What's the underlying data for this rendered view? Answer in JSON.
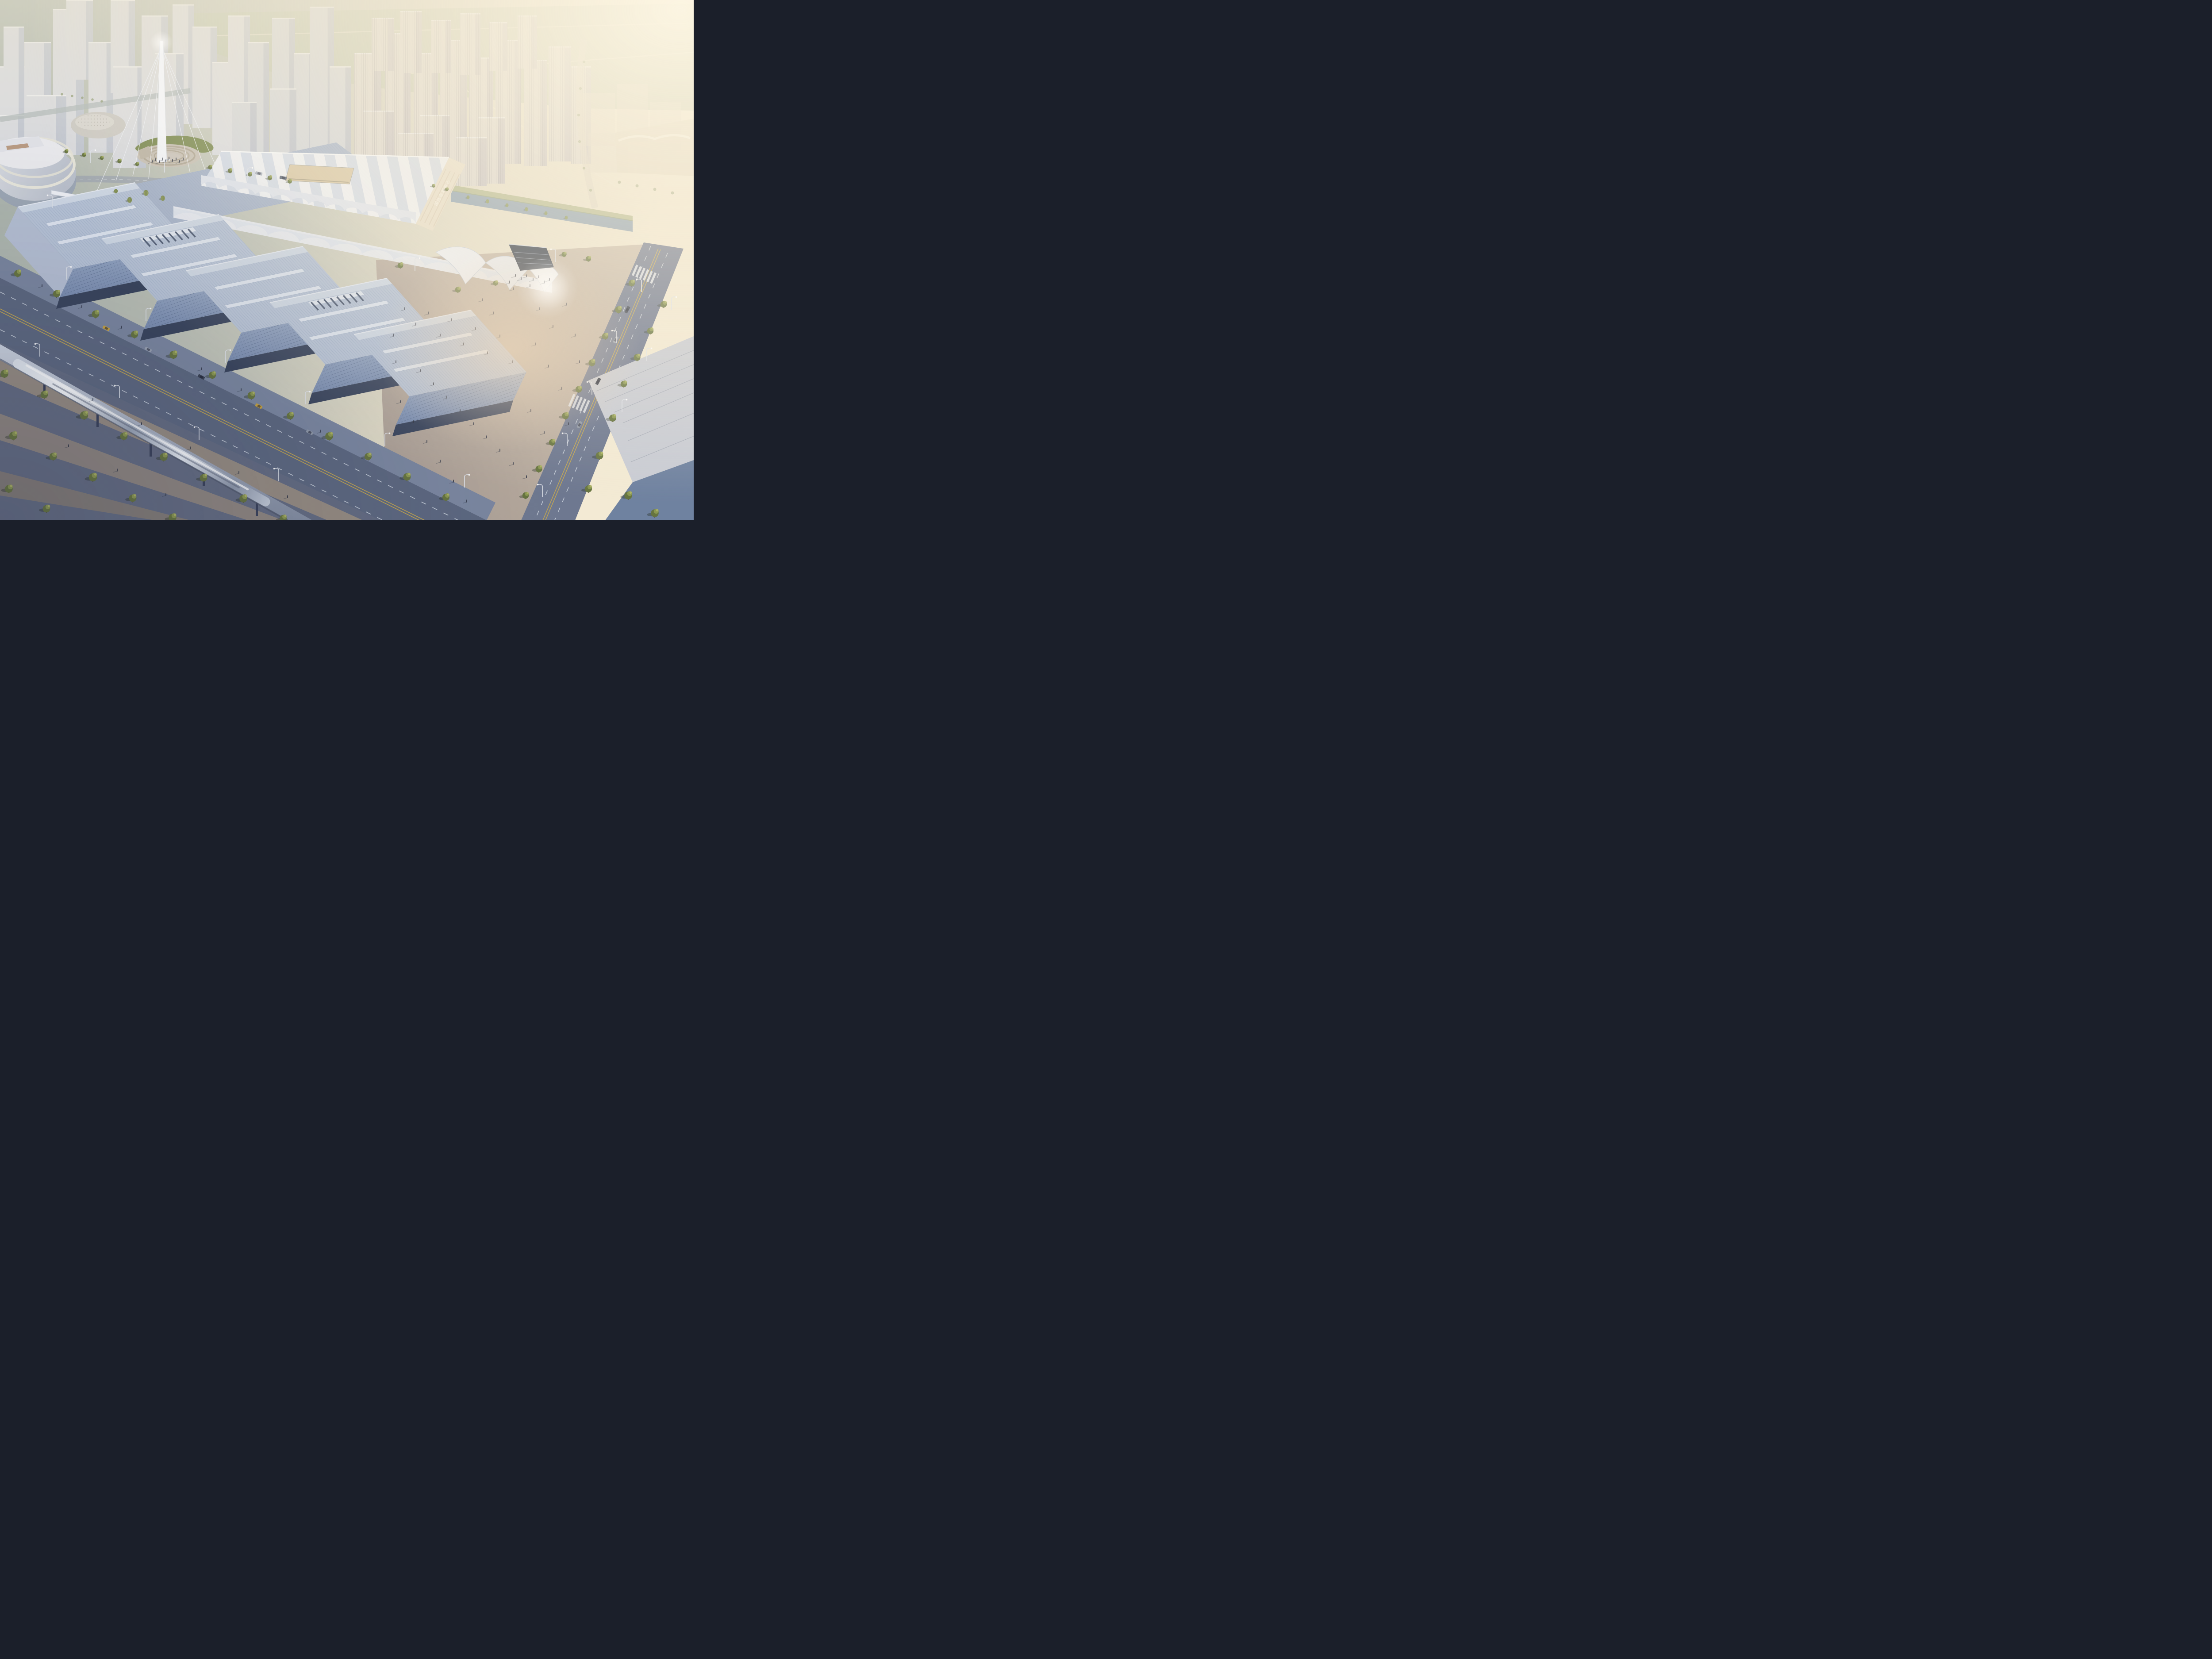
{
  "sign": {
    "text": "国际会展中心"
  },
  "palette": {
    "sky_left": "#a9b3ac",
    "sky_warm": "#f1e7cf",
    "glow": "#fdf6e3",
    "field": "#b7c0a8",
    "tower_face": "#d7dae2",
    "tower_side": "#bcc3d2",
    "cream_tower": "#d9d5d0",
    "cream_side": "#c2bec3",
    "tent_white": "#eef0f4",
    "tent_shade": "#dfe4ee",
    "tent_facade": "#e7ddc9",
    "roof_rib": "#b9c5d8",
    "roof_back": "#a7b4ca",
    "facade_top": "#9aabc6",
    "facade_bottom": "#7b8eb1",
    "arcade": "#39445c",
    "road_dark": "#5d6880",
    "road_mid": "#6e7890",
    "sidewalk": "#7b87a0",
    "park_ground": "#646c82",
    "path_tan": "#9f9283",
    "plaza_warm": "#b5a9a1",
    "plaza_glare": "#f0d9ba",
    "water": "#7e96ad",
    "tree_green": "#66743f",
    "tree_light": "#aab163",
    "willow": "#7d8b4f",
    "mast_white": "#f4f6f9",
    "train_silver": "#c9d1dd",
    "lane_yellow": "#c8a94e",
    "lane_white": "#dfe5ee",
    "wedge_dark": "#2f3848"
  },
  "scene": {
    "bg_left": [
      [
        0,
        150,
        70,
        260
      ],
      [
        55,
        95,
        60,
        300
      ],
      [
        8,
        60,
        46,
        210
      ],
      [
        120,
        20,
        70,
        330
      ],
      [
        150,
        0,
        60,
        180
      ],
      [
        200,
        95,
        55,
        250
      ],
      [
        250,
        0,
        55,
        210
      ],
      [
        255,
        150,
        75,
        230
      ],
      [
        320,
        35,
        60,
        300
      ],
      [
        390,
        10,
        48,
        270
      ],
      [
        350,
        120,
        65,
        250
      ],
      [
        435,
        60,
        55,
        230
      ],
      [
        60,
        215,
        90,
        190
      ],
      [
        0,
        260,
        55,
        170
      ],
      [
        480,
        140,
        60,
        210
      ],
      [
        515,
        35,
        50,
        230
      ]
    ],
    "bg_mid": [
      [
        560,
        95,
        48,
        260
      ],
      [
        615,
        40,
        52,
        300
      ],
      [
        665,
        120,
        45,
        230
      ],
      [
        700,
        15,
        55,
        320
      ],
      [
        745,
        150,
        48,
        210
      ],
      [
        610,
        200,
        60,
        170
      ],
      [
        525,
        230,
        55,
        160
      ]
    ],
    "bg_res": [
      [
        800,
        120,
        62,
        260
      ],
      [
        870,
        75,
        58,
        300
      ],
      [
        935,
        120,
        55,
        260
      ],
      [
        995,
        90,
        60,
        290
      ],
      [
        1060,
        130,
        55,
        250
      ],
      [
        1120,
        90,
        58,
        280
      ],
      [
        1185,
        135,
        52,
        240
      ],
      [
        1240,
        105,
        50,
        260
      ],
      [
        1290,
        150,
        46,
        220
      ],
      [
        820,
        250,
        70,
        170
      ],
      [
        950,
        260,
        66,
        160
      ],
      [
        1080,
        265,
        62,
        150
      ],
      [
        900,
        300,
        80,
        120
      ],
      [
        1030,
        310,
        70,
        110
      ],
      [
        840,
        40,
        50,
        120
      ],
      [
        905,
        25,
        48,
        140
      ],
      [
        975,
        45,
        44,
        120
      ],
      [
        1040,
        30,
        46,
        140
      ],
      [
        1105,
        50,
        42,
        110
      ],
      [
        1170,
        35,
        44,
        120
      ]
    ],
    "bg_far": [
      [
        1310,
        210,
        80,
        120
      ],
      [
        1395,
        190,
        70,
        130
      ],
      [
        1470,
        230,
        70,
        110
      ],
      [
        1330,
        300,
        90,
        90
      ]
    ],
    "halls": [
      {
        "p": [
          40,
          468
        ],
        "vent": false
      },
      {
        "p": [
          230,
          540
        ],
        "vent": true
      },
      {
        "p": [
          420,
          612
        ],
        "vent": false
      },
      {
        "p": [
          610,
          684
        ],
        "vent": true
      },
      {
        "p": [
          800,
          756
        ],
        "vent": false
      }
    ],
    "trees": [
      [
        40,
        618,
        1,
        0
      ],
      [
        128,
        664,
        1,
        0
      ],
      [
        216,
        710,
        1.05,
        0
      ],
      [
        304,
        756,
        1,
        0
      ],
      [
        392,
        802,
        1.1,
        0
      ],
      [
        480,
        848,
        1,
        0
      ],
      [
        568,
        894,
        1.05,
        0
      ],
      [
        656,
        940,
        1,
        0
      ],
      [
        744,
        986,
        1.1,
        0
      ],
      [
        832,
        1032,
        1,
        0
      ],
      [
        920,
        1078,
        1.05,
        0
      ],
      [
        1008,
        1124,
        1,
        0
      ],
      [
        10,
        845,
        1.1,
        0
      ],
      [
        100,
        892,
        1.05,
        0
      ],
      [
        190,
        939,
        1.15,
        0
      ],
      [
        280,
        986,
        1.05,
        0
      ],
      [
        370,
        1033,
        1.1,
        0
      ],
      [
        460,
        1080,
        1.05,
        0
      ],
      [
        550,
        1127,
        1.1,
        0
      ],
      [
        640,
        1172,
        1,
        0
      ],
      [
        30,
        985,
        1.15,
        0
      ],
      [
        120,
        1032,
        1.05,
        0
      ],
      [
        210,
        1079,
        1.15,
        0
      ],
      [
        300,
        1126,
        1.05,
        0
      ],
      [
        390,
        1170,
        1.1,
        0
      ],
      [
        20,
        1105,
        1.1,
        0
      ],
      [
        105,
        1150,
        1.05,
        0
      ],
      [
        150,
        342,
        0.55,
        0
      ],
      [
        190,
        350,
        0.6,
        0
      ],
      [
        230,
        357,
        0.55,
        0
      ],
      [
        270,
        364,
        0.6,
        0
      ],
      [
        310,
        371,
        0.55,
        0
      ],
      [
        475,
        378,
        0.6,
        0
      ],
      [
        520,
        386,
        0.65,
        0
      ],
      [
        565,
        394,
        0.6,
        0
      ],
      [
        610,
        402,
        0.65,
        0
      ],
      [
        655,
        410,
        0.6,
        0
      ],
      [
        330,
        436,
        0.8,
        1
      ],
      [
        293,
        452,
        0.75,
        1
      ],
      [
        368,
        448,
        0.7,
        1
      ],
      [
        262,
        432,
        0.6,
        1
      ],
      [
        140,
        213,
        0.4,
        2
      ],
      [
        163,
        217,
        0.4,
        2
      ],
      [
        186,
        221,
        0.4,
        2
      ],
      [
        209,
        225,
        0.4,
        2
      ],
      [
        230,
        229,
        0.4,
        2
      ],
      [
        1058,
        446,
        0.5,
        1
      ],
      [
        1102,
        455,
        0.55,
        1
      ],
      [
        1146,
        464,
        0.5,
        1
      ],
      [
        1190,
        473,
        0.55,
        1
      ],
      [
        1234,
        482,
        0.5,
        1
      ],
      [
        1280,
        492,
        0.5,
        1
      ],
      [
        905,
        600,
        0.8,
        0
      ],
      [
        1275,
        575,
        0.7,
        0
      ],
      [
        1330,
        585,
        0.75,
        0
      ],
      [
        1428,
        640,
        0.9,
        0
      ],
      [
        1398,
        700,
        0.95,
        0
      ],
      [
        1368,
        760,
        0.9,
        0
      ],
      [
        1338,
        820,
        0.95,
        0
      ],
      [
        1308,
        880,
        0.9,
        0
      ],
      [
        1278,
        940,
        0.95,
        0
      ],
      [
        1248,
        1000,
        0.9,
        0
      ],
      [
        1218,
        1060,
        0.95,
        0
      ],
      [
        1188,
        1120,
        0.9,
        0
      ],
      [
        1500,
        688,
        0.9,
        0
      ],
      [
        1470,
        748,
        0.9,
        0
      ],
      [
        1440,
        808,
        0.95,
        0
      ],
      [
        1410,
        868,
        0.9,
        0
      ],
      [
        1385,
        945,
        1.0,
        0
      ],
      [
        1355,
        1030,
        1.05,
        0
      ],
      [
        1420,
        1120,
        1.1,
        0
      ],
      [
        1330,
        1105,
        1,
        0
      ],
      [
        1480,
        1160,
        1.1,
        0
      ],
      [
        1035,
        655,
        0.8,
        0
      ],
      [
        1120,
        640,
        0.7,
        0
      ],
      [
        980,
        420,
        0.5,
        0
      ],
      [
        1010,
        428,
        0.5,
        0
      ],
      [
        1320,
        140,
        0.45,
        2
      ],
      [
        1312,
        200,
        0.45,
        2
      ],
      [
        1308,
        260,
        0.45,
        2
      ],
      [
        1310,
        320,
        0.45,
        2
      ],
      [
        1320,
        380,
        0.45,
        2
      ],
      [
        1335,
        430,
        0.45,
        2
      ],
      [
        1400,
        412,
        0.5,
        2
      ],
      [
        1440,
        420,
        0.5,
        2
      ],
      [
        1480,
        428,
        0.5,
        2
      ],
      [
        1520,
        436,
        0.5,
        2
      ]
    ],
    "people": [
      [
        368,
        362
      ],
      [
        375,
        366
      ],
      [
        382,
        360
      ],
      [
        390,
        365
      ],
      [
        398,
        362
      ],
      [
        360,
        368
      ],
      [
        406,
        367
      ],
      [
        352,
        363
      ],
      [
        414,
        362
      ],
      [
        344,
        367
      ],
      [
        1165,
        625
      ],
      [
        1178,
        632
      ],
      [
        1190,
        626
      ],
      [
        1205,
        634
      ],
      [
        1218,
        628
      ],
      [
        1152,
        640
      ],
      [
        1230,
        640
      ],
      [
        1242,
        634
      ],
      [
        1198,
        648
      ],
      [
        1160,
        655
      ],
      [
        915,
        700
      ],
      [
        940,
        735
      ],
      [
        968,
        710
      ],
      [
        995,
        760
      ],
      [
        1020,
        725
      ],
      [
        1048,
        780
      ],
      [
        1075,
        745
      ],
      [
        1102,
        800
      ],
      [
        1130,
        762
      ],
      [
        1158,
        820
      ],
      [
        950,
        840
      ],
      [
        980,
        870
      ],
      [
        1010,
        900
      ],
      [
        1040,
        930
      ],
      [
        1070,
        960
      ],
      [
        1100,
        990
      ],
      [
        1130,
        1020
      ],
      [
        1160,
        1050
      ],
      [
        1190,
        1080
      ],
      [
        905,
        910
      ],
      [
        935,
        955
      ],
      [
        965,
        1000
      ],
      [
        995,
        1045
      ],
      [
        1025,
        1090
      ],
      [
        1055,
        1135
      ],
      [
        1220,
        700
      ],
      [
        1250,
        740
      ],
      [
        1280,
        690
      ],
      [
        1210,
        780
      ],
      [
        1240,
        830
      ],
      [
        1270,
        880
      ],
      [
        1200,
        930
      ],
      [
        1230,
        980
      ],
      [
        1090,
        680
      ],
      [
        1115,
        710
      ],
      [
        890,
        760
      ],
      [
        895,
        820
      ],
      [
        1300,
        760
      ],
      [
        1310,
        820
      ],
      [
        1285,
        960
      ],
      [
        95,
        648
      ],
      [
        185,
        695
      ],
      [
        275,
        742
      ],
      [
        455,
        836
      ],
      [
        545,
        883
      ],
      [
        725,
        977
      ],
      [
        210,
        905
      ],
      [
        320,
        960
      ],
      [
        430,
        1015
      ],
      [
        540,
        1070
      ],
      [
        650,
        1125
      ],
      [
        155,
        1010
      ],
      [
        265,
        1065
      ],
      [
        375,
        1120
      ]
    ],
    "cars": [
      [
        240,
        742,
        27,
        "#c7a23f"
      ],
      [
        335,
        790,
        27,
        "#99a2b2"
      ],
      [
        455,
        852,
        27,
        "#3a4254"
      ],
      [
        585,
        918,
        27,
        "#c7a23f"
      ],
      [
        700,
        977,
        27,
        "#8e97a6"
      ],
      [
        1418,
        700,
        118,
        "#39414f"
      ],
      [
        1392,
        768,
        118,
        "#9aa3b2"
      ],
      [
        1352,
        862,
        118,
        "#2f3746"
      ],
      [
        1310,
        960,
        118,
        "#8e97a6"
      ],
      [
        585,
        392,
        12,
        "#aab2bf"
      ],
      [
        640,
        402,
        12,
        "#5a6375"
      ]
    ],
    "lamps": [
      [
        150,
        632,
        0
      ],
      [
        330,
        726,
        0
      ],
      [
        510,
        820,
        0
      ],
      [
        690,
        914,
        0
      ],
      [
        870,
        1008,
        0
      ],
      [
        1050,
        1102,
        0
      ],
      [
        90,
        806,
        1
      ],
      [
        270,
        900,
        1
      ],
      [
        450,
        994,
        1
      ],
      [
        630,
        1088,
        1
      ],
      [
        1450,
        660,
        1
      ],
      [
        1394,
        776,
        1
      ],
      [
        1338,
        892,
        1
      ],
      [
        1282,
        1008,
        1
      ],
      [
        1226,
        1124,
        1
      ],
      [
        1518,
        700,
        0
      ],
      [
        1462,
        816,
        0
      ],
      [
        1406,
        932,
        0
      ],
      [
        938,
        612,
        0
      ],
      [
        1256,
        592,
        1
      ],
      [
        205,
        368,
        0
      ],
      [
        372,
        390,
        0
      ],
      [
        560,
        408,
        0
      ],
      [
        118,
        470,
        1
      ]
    ]
  }
}
